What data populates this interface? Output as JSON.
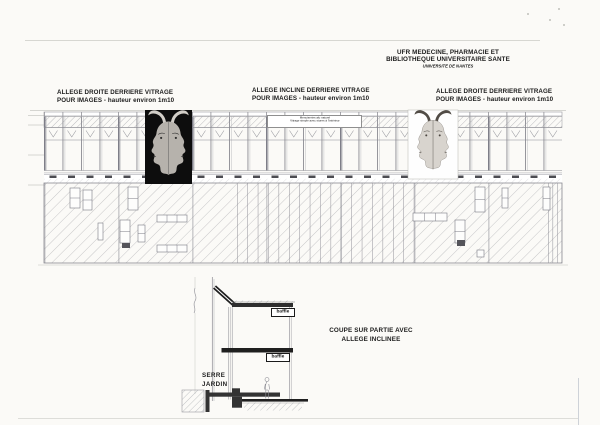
{
  "document": {
    "header": {
      "line1": "UFR MEDECINE, PHARMACIE ET",
      "line2": "BIBLIOTHEQUE UNIVERSITAIRE SANTE",
      "line3": "UNIVERSITE DE NANTES"
    },
    "facade_labels": {
      "left": {
        "line1": "ALLEGE DROITE DERRIERE VITRAGE",
        "line2": "POUR IMAGES - hauteur environ 1m10"
      },
      "center": {
        "line1": "ALLEGE INCLINE DERRIERE VITRAGE",
        "line2": "POUR IMAGES - hauteur environ 1m10"
      },
      "right": {
        "line1": "ALLEGE DROITE DERRIERE VITRAGE",
        "line2": "POUR IMAGES - hauteur environ 1m10"
      }
    },
    "elevation": {
      "glazing_note": {
        "line1": "Menuiseries alu naturel",
        "line2": "Vitrage simple avec stores à l'intérieur"
      }
    },
    "section": {
      "baffle_top": "baffle",
      "baffle_mid": "baffle",
      "room_label": {
        "line1": "SERRE",
        "line2": "JARDIN"
      },
      "caption": {
        "line1": "COUPE SUR PARTIE AVEC",
        "line2": "ALLEGE INCLINEE"
      }
    },
    "colors": {
      "paper": "#fbfaf7",
      "drawing_line": "#8a8a92",
      "dark_ink": "#1f1f1f",
      "image_left_background": "#0d0d0d",
      "image_right_background": "#fefefe"
    }
  }
}
